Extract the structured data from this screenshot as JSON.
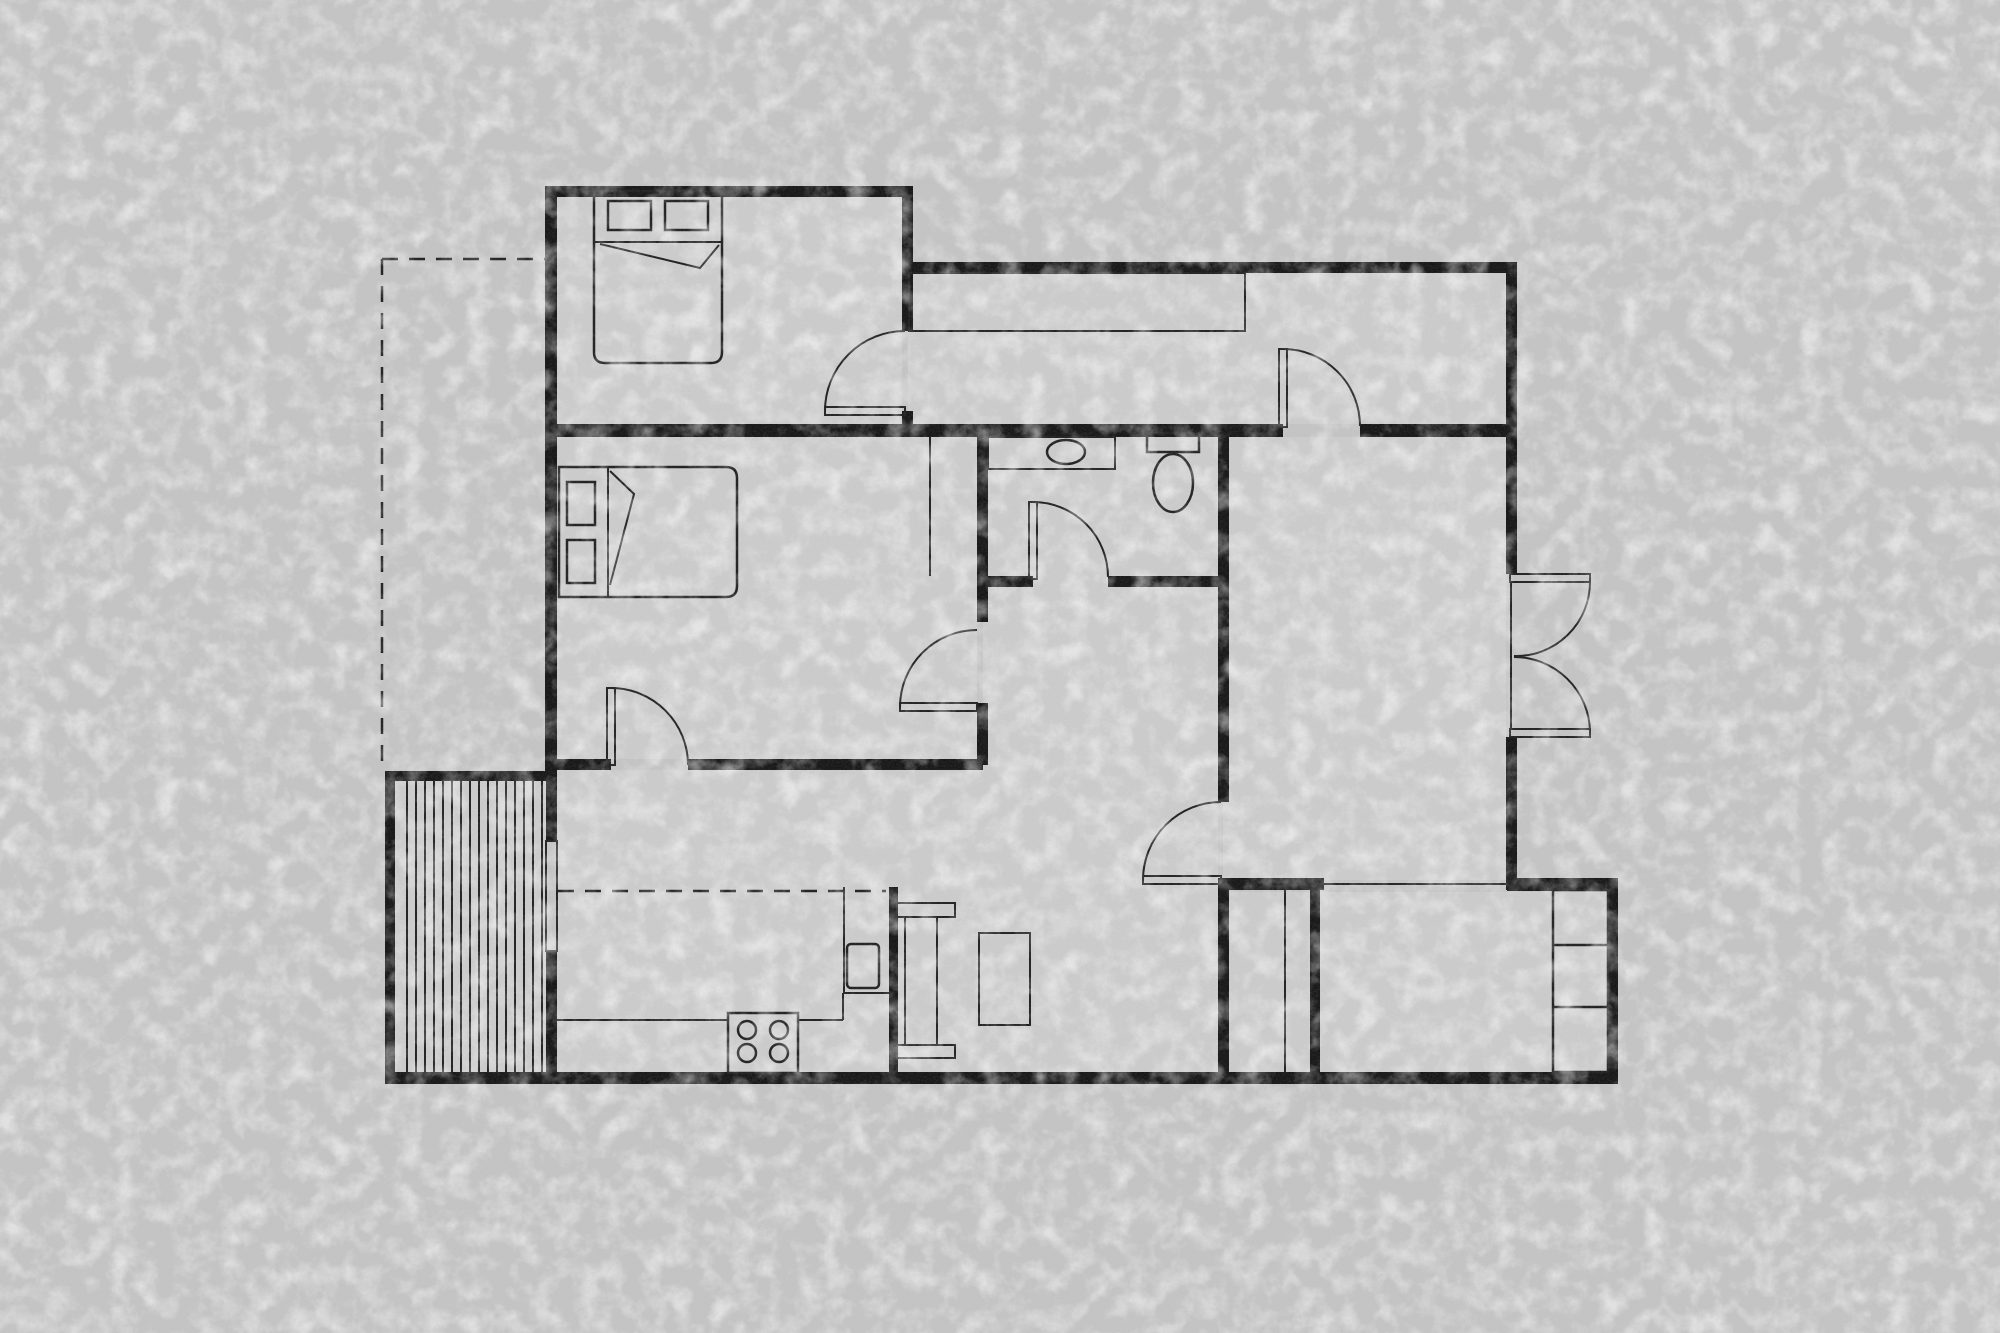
{
  "meta": {
    "title": "apartment-floor-plan",
    "width": 2000,
    "height": 1333
  },
  "colors": {
    "background": "#c5c5c5",
    "floor": "#cdcdcd",
    "wall": "#121212",
    "line": "#1c1c1c"
  },
  "floors": [
    {
      "n": "floor-bedroom-1",
      "x": 557,
      "y": 197,
      "w": 345,
      "h": 227
    },
    {
      "n": "floor-corridor",
      "x": 908,
      "y": 273,
      "w": 598,
      "h": 151
    },
    {
      "n": "floor-bedroom-2",
      "x": 557,
      "y": 437,
      "w": 420,
      "h": 322
    },
    {
      "n": "floor-bathroom-hall",
      "x": 983,
      "y": 437,
      "w": 235,
      "h": 443
    },
    {
      "n": "floor-kitchen-living",
      "x": 557,
      "y": 770,
      "w": 661,
      "h": 302
    },
    {
      "n": "floor-big-room",
      "x": 1223,
      "y": 437,
      "w": 283,
      "h": 443
    },
    {
      "n": "floor-entry-room",
      "x": 1223,
      "y": 892,
      "w": 385,
      "h": 180
    },
    {
      "n": "floor-deck",
      "x": 395,
      "y": 781,
      "w": 151,
      "h": 291
    }
  ],
  "walls": [
    {
      "n": "wall-bedroom1-top",
      "x": 545,
      "y": 186,
      "w": 368,
      "h": 11
    },
    {
      "n": "wall-west",
      "x": 545,
      "y": 186,
      "w": 12,
      "h": 585
    },
    {
      "n": "wall-bedroom1-right",
      "x": 902,
      "y": 186,
      "w": 11,
      "h": 145
    },
    {
      "n": "wall-corridor-top",
      "x": 908,
      "y": 262,
      "w": 609,
      "h": 11
    },
    {
      "n": "wall-east-upper",
      "x": 1506,
      "y": 262,
      "w": 11,
      "h": 312
    },
    {
      "n": "wall-doorA-stub",
      "x": 902,
      "y": 411,
      "w": 11,
      "h": 19
    },
    {
      "n": "wall-main-horizontal-left",
      "x": 545,
      "y": 424,
      "w": 738,
      "h": 13
    },
    {
      "n": "wall-main-horizontal-right",
      "x": 1360,
      "y": 424,
      "w": 157,
      "h": 13
    },
    {
      "n": "wall-bedroom2-right-upper",
      "x": 977,
      "y": 437,
      "w": 11,
      "h": 185
    },
    {
      "n": "wall-bedroom2-right-lower",
      "x": 977,
      "y": 703,
      "w": 11,
      "h": 62
    },
    {
      "n": "wall-bath-bottom-left",
      "x": 977,
      "y": 576,
      "w": 56,
      "h": 11
    },
    {
      "n": "wall-bath-bottom-right",
      "x": 1108,
      "y": 576,
      "w": 115,
      "h": 11
    },
    {
      "n": "wall-bigroom-west-upper",
      "x": 1218,
      "y": 424,
      "w": 11,
      "h": 378
    },
    {
      "n": "wall-bigroom-west-lower",
      "x": 1218,
      "y": 883,
      "w": 11,
      "h": 201
    },
    {
      "n": "wall-kitchen-top-left",
      "x": 545,
      "y": 759,
      "w": 66,
      "h": 11
    },
    {
      "n": "wall-kitchen-top-right",
      "x": 688,
      "y": 759,
      "w": 295,
      "h": 11
    },
    {
      "n": "wall-laundry-top",
      "x": 1218,
      "y": 878,
      "w": 106,
      "h": 12
    },
    {
      "n": "wall-entry-top",
      "x": 1507,
      "y": 878,
      "w": 111,
      "h": 13
    },
    {
      "n": "wall-laundry-right",
      "x": 1310,
      "y": 878,
      "w": 10,
      "h": 206
    },
    {
      "n": "wall-east-lower",
      "x": 1608,
      "y": 878,
      "w": 10,
      "h": 206
    },
    {
      "n": "wall-bottom",
      "x": 385,
      "y": 1072,
      "w": 1233,
      "h": 12
    },
    {
      "n": "wall-deck-west",
      "x": 385,
      "y": 771,
      "w": 10,
      "h": 313
    },
    {
      "n": "wall-deck-top",
      "x": 385,
      "y": 771,
      "w": 172,
      "h": 10
    },
    {
      "n": "wall-kitchen-west-upper",
      "x": 546,
      "y": 771,
      "w": 11,
      "h": 70
    },
    {
      "n": "wall-kitchen-west-lower",
      "x": 546,
      "y": 951,
      "w": 11,
      "h": 133
    },
    {
      "n": "wall-kitchen-stub",
      "x": 889,
      "y": 887,
      "w": 9,
      "h": 197
    },
    {
      "n": "wall-east-mid",
      "x": 1506,
      "y": 737,
      "w": 11,
      "h": 153
    }
  ],
  "details": [
    {
      "t": "path",
      "n": "bed-1-outline",
      "d": "M594 191 L722 191 L722 352 Q722 363 711 363 L605 363 Q594 363 594 352 Z",
      "sw": 2.5
    },
    {
      "t": "orect",
      "n": "bed-1-pillow-left",
      "x": 608,
      "y": 201,
      "w": 43,
      "h": 29,
      "sw": 2.5
    },
    {
      "t": "orect",
      "n": "bed-1-pillow-right",
      "x": 665,
      "y": 201,
      "w": 43,
      "h": 29,
      "sw": 2.5
    },
    {
      "t": "path",
      "n": "bed-1-blanket-fold",
      "d": "M594 242 L722 242 M600 244 L700 268 L719 245",
      "sw": 2
    },
    {
      "t": "path",
      "n": "bed-2-outline",
      "d": "M559 467 L726 467 Q737 467 737 478 L737 586 Q737 597 726 597 L559 597 Z",
      "sw": 2.5
    },
    {
      "t": "orect",
      "n": "bed-2-pillow-top",
      "x": 567,
      "y": 482,
      "w": 28,
      "h": 43,
      "sw": 2.5
    },
    {
      "t": "orect",
      "n": "bed-2-pillow-bottom",
      "x": 567,
      "y": 540,
      "w": 28,
      "h": 43,
      "sw": 2.5
    },
    {
      "t": "path",
      "n": "bed-2-blanket-fold",
      "d": "M608 467 L608 597 M610 471 L634 494 L610 585",
      "sw": 2
    },
    {
      "t": "orect",
      "n": "corridor-closet",
      "x": 909,
      "y": 273,
      "w": 336,
      "h": 58,
      "sw": 2
    },
    {
      "t": "line",
      "n": "bedroom2-closet-line",
      "x1": 930,
      "y1": 437,
      "x2": 930,
      "y2": 576,
      "sw": 2
    },
    {
      "t": "orect",
      "n": "bathroom-vanity",
      "x": 988,
      "y": 437,
      "w": 127,
      "h": 32,
      "sw": 2
    },
    {
      "t": "ellipse",
      "n": "bathroom-sink",
      "cx": 1066,
      "cy": 452,
      "rx": 19,
      "ry": 12,
      "sw": 2.5
    },
    {
      "t": "orect",
      "n": "toilet-tank",
      "x": 1147,
      "y": 433,
      "w": 52,
      "h": 19,
      "sw": 2.5
    },
    {
      "t": "ellipse",
      "n": "toilet-bowl",
      "cx": 1173,
      "cy": 483,
      "rx": 20,
      "ry": 29,
      "sw": 2.5
    },
    {
      "t": "orect",
      "n": "door-bedroom1-leaf",
      "x": 825,
      "y": 407,
      "w": 80,
      "h": 8,
      "sw": 2
    },
    {
      "t": "path",
      "n": "door-bedroom1-swing",
      "d": "M825 411 A80 80 0 0 1 905 331",
      "sw": 2
    },
    {
      "t": "orect",
      "n": "door-corridor-leaf",
      "x": 1279,
      "y": 349,
      "w": 8,
      "h": 78,
      "sw": 2
    },
    {
      "t": "path",
      "n": "door-corridor-swing",
      "d": "M1283 349 A77 77 0 0 1 1360 426",
      "sw": 2
    },
    {
      "t": "orect",
      "n": "door-bathroom-leaf",
      "x": 1029,
      "y": 502,
      "w": 8,
      "h": 77,
      "sw": 2
    },
    {
      "t": "path",
      "n": "door-bathroom-swing",
      "d": "M1033 502 A75 75 0 0 1 1108 577",
      "sw": 2
    },
    {
      "t": "orect",
      "n": "door-bedroom2-east-leaf",
      "x": 900,
      "y": 703,
      "w": 77,
      "h": 8,
      "sw": 2
    },
    {
      "t": "path",
      "n": "door-bedroom2-east-swing",
      "d": "M900 707 A77 77 0 0 1 977 630",
      "sw": 2
    },
    {
      "t": "orect",
      "n": "door-kitchen-leaf",
      "x": 607,
      "y": 688,
      "w": 8,
      "h": 77,
      "sw": 2
    },
    {
      "t": "path",
      "n": "door-kitchen-swing",
      "d": "M611 688 A77 77 0 0 1 688 765",
      "sw": 2
    },
    {
      "t": "orect",
      "n": "door-bigroom-leaf",
      "x": 1143,
      "y": 876,
      "w": 78,
      "h": 8,
      "sw": 2
    },
    {
      "t": "path",
      "n": "door-bigroom-swing",
      "d": "M1143 880 A78 78 0 0 1 1221 802",
      "sw": 2
    },
    {
      "t": "orect",
      "n": "french-door-top-leaf",
      "x": 1510,
      "y": 574,
      "w": 80,
      "h": 8,
      "sw": 2
    },
    {
      "t": "orect",
      "n": "french-door-bottom-leaf",
      "x": 1510,
      "y": 729,
      "w": 80,
      "h": 8,
      "sw": 2
    },
    {
      "t": "path",
      "n": "french-door-top-swing",
      "d": "M1590 582 A74 74 0 0 1 1514 656",
      "sw": 2
    },
    {
      "t": "path",
      "n": "french-door-bottom-swing",
      "d": "M1590 731 A76 76 0 0 0 1514 657",
      "sw": 2
    },
    {
      "t": "line",
      "n": "french-door-threshold",
      "x1": 1511,
      "y1": 582,
      "x2": 1511,
      "y2": 729,
      "sw": 2
    },
    {
      "t": "line",
      "n": "kitchen-counter-edge-a",
      "x1": 557,
      "y1": 1020,
      "x2": 728,
      "y2": 1020,
      "sw": 2
    },
    {
      "t": "line",
      "n": "kitchen-counter-edge-b",
      "x1": 798,
      "y1": 1020,
      "x2": 843,
      "y2": 1020,
      "sw": 2
    },
    {
      "t": "line",
      "n": "kitchen-counter-return",
      "x1": 843,
      "y1": 993,
      "x2": 843,
      "y2": 1020,
      "sw": 2
    },
    {
      "t": "line",
      "n": "oven-column-left",
      "x1": 844,
      "y1": 887,
      "x2": 844,
      "y2": 993,
      "sw": 2
    },
    {
      "t": "line",
      "n": "oven-column-bottom",
      "x1": 844,
      "y1": 993,
      "x2": 889,
      "y2": 993,
      "sw": 2
    },
    {
      "t": "orect",
      "n": "oven",
      "x": 847,
      "y": 944,
      "w": 32,
      "h": 44,
      "rx": 4,
      "sw": 2.5
    },
    {
      "t": "orect",
      "n": "stove",
      "x": 728,
      "y": 1013,
      "w": 70,
      "h": 60,
      "sw": 2.5
    },
    {
      "t": "circle",
      "n": "burner-1",
      "cx": 747,
      "cy": 1030,
      "r": 9,
      "sw": 2.5
    },
    {
      "t": "circle",
      "n": "burner-2",
      "cx": 779,
      "cy": 1030,
      "r": 9,
      "sw": 2.5
    },
    {
      "t": "circle",
      "n": "burner-3",
      "cx": 747,
      "cy": 1053,
      "r": 9,
      "sw": 2.5
    },
    {
      "t": "circle",
      "n": "burner-4",
      "cx": 779,
      "cy": 1053,
      "r": 9,
      "sw": 2.5
    },
    {
      "t": "orect",
      "n": "deck-window",
      "x": 546,
      "y": 841,
      "w": 11,
      "h": 110,
      "sw": 2
    },
    {
      "t": "orect",
      "n": "dining-chair-top",
      "x": 897,
      "y": 903,
      "w": 58,
      "h": 14,
      "sw": 2
    },
    {
      "t": "orect",
      "n": "dining-chair-bottom",
      "x": 897,
      "y": 1045,
      "w": 58,
      "h": 13,
      "sw": 2
    },
    {
      "t": "orect",
      "n": "dining-table",
      "x": 905,
      "y": 917,
      "w": 32,
      "h": 128,
      "sw": 2
    },
    {
      "t": "orect",
      "n": "island-table",
      "x": 979,
      "y": 933,
      "w": 51,
      "h": 92,
      "sw": 2
    },
    {
      "t": "orect",
      "n": "entry-shelf-unit",
      "x": 1553,
      "y": 890,
      "w": 55,
      "h": 182,
      "sw": 2.5
    },
    {
      "t": "line",
      "n": "entry-shelf-divider-1",
      "x1": 1553,
      "y1": 945,
      "x2": 1608,
      "y2": 945,
      "sw": 2.5
    },
    {
      "t": "line",
      "n": "entry-shelf-divider-2",
      "x1": 1553,
      "y1": 1007,
      "x2": 1608,
      "y2": 1007,
      "sw": 2.5
    },
    {
      "t": "line",
      "n": "bigroom-entry-opening-line",
      "x1": 1320,
      "y1": 884,
      "x2": 1507,
      "y2": 884,
      "sw": 2
    },
    {
      "t": "line",
      "n": "laundry-divider",
      "x1": 1285,
      "y1": 890,
      "x2": 1285,
      "y2": 1072,
      "sw": 2
    },
    {
      "t": "line",
      "n": "deck-board-1",
      "x1": 407,
      "y1": 781,
      "x2": 407,
      "y2": 1072,
      "sw": 2
    },
    {
      "t": "line",
      "n": "deck-board-2",
      "x1": 416,
      "y1": 781,
      "x2": 416,
      "y2": 1072,
      "sw": 2
    },
    {
      "t": "line",
      "n": "deck-board-3",
      "x1": 425,
      "y1": 781,
      "x2": 425,
      "y2": 1072,
      "sw": 2
    },
    {
      "t": "line",
      "n": "deck-board-4",
      "x1": 434,
      "y1": 781,
      "x2": 434,
      "y2": 1072,
      "sw": 2
    },
    {
      "t": "line",
      "n": "deck-board-5",
      "x1": 443,
      "y1": 781,
      "x2": 443,
      "y2": 1072,
      "sw": 2
    },
    {
      "t": "line",
      "n": "deck-board-6",
      "x1": 452,
      "y1": 781,
      "x2": 452,
      "y2": 1072,
      "sw": 2
    },
    {
      "t": "line",
      "n": "deck-board-7",
      "x1": 461,
      "y1": 781,
      "x2": 461,
      "y2": 1072,
      "sw": 2
    },
    {
      "t": "line",
      "n": "deck-board-8",
      "x1": 470,
      "y1": 781,
      "x2": 470,
      "y2": 1072,
      "sw": 2
    },
    {
      "t": "line",
      "n": "deck-board-9",
      "x1": 479,
      "y1": 781,
      "x2": 479,
      "y2": 1072,
      "sw": 2
    },
    {
      "t": "line",
      "n": "deck-board-10",
      "x1": 488,
      "y1": 781,
      "x2": 488,
      "y2": 1072,
      "sw": 2
    },
    {
      "t": "line",
      "n": "deck-board-11",
      "x1": 497,
      "y1": 781,
      "x2": 497,
      "y2": 1072,
      "sw": 2
    },
    {
      "t": "line",
      "n": "deck-board-12",
      "x1": 506,
      "y1": 781,
      "x2": 506,
      "y2": 1072,
      "sw": 2
    },
    {
      "t": "line",
      "n": "deck-board-13",
      "x1": 515,
      "y1": 781,
      "x2": 515,
      "y2": 1072,
      "sw": 2
    },
    {
      "t": "line",
      "n": "deck-board-14",
      "x1": 524,
      "y1": 781,
      "x2": 524,
      "y2": 1072,
      "sw": 2
    },
    {
      "t": "line",
      "n": "deck-board-15",
      "x1": 533,
      "y1": 781,
      "x2": 533,
      "y2": 1072,
      "sw": 2
    },
    {
      "t": "line",
      "n": "deck-board-16",
      "x1": 542,
      "y1": 781,
      "x2": 542,
      "y2": 1072,
      "sw": 2
    },
    {
      "t": "dline",
      "n": "setback-dashed-horizontal",
      "x1": 382,
      "y1": 259,
      "x2": 545,
      "y2": 259,
      "sw": 2.5,
      "dash": "16 11"
    },
    {
      "t": "dline",
      "n": "setback-dashed-vertical",
      "x1": 382,
      "y1": 259,
      "x2": 382,
      "y2": 771,
      "sw": 2.5,
      "dash": "16 11"
    },
    {
      "t": "dline",
      "n": "kitchen-overhead-dashed",
      "x1": 558,
      "y1": 891,
      "x2": 886,
      "y2": 891,
      "sw": 2.5,
      "dash": "16 11"
    }
  ]
}
